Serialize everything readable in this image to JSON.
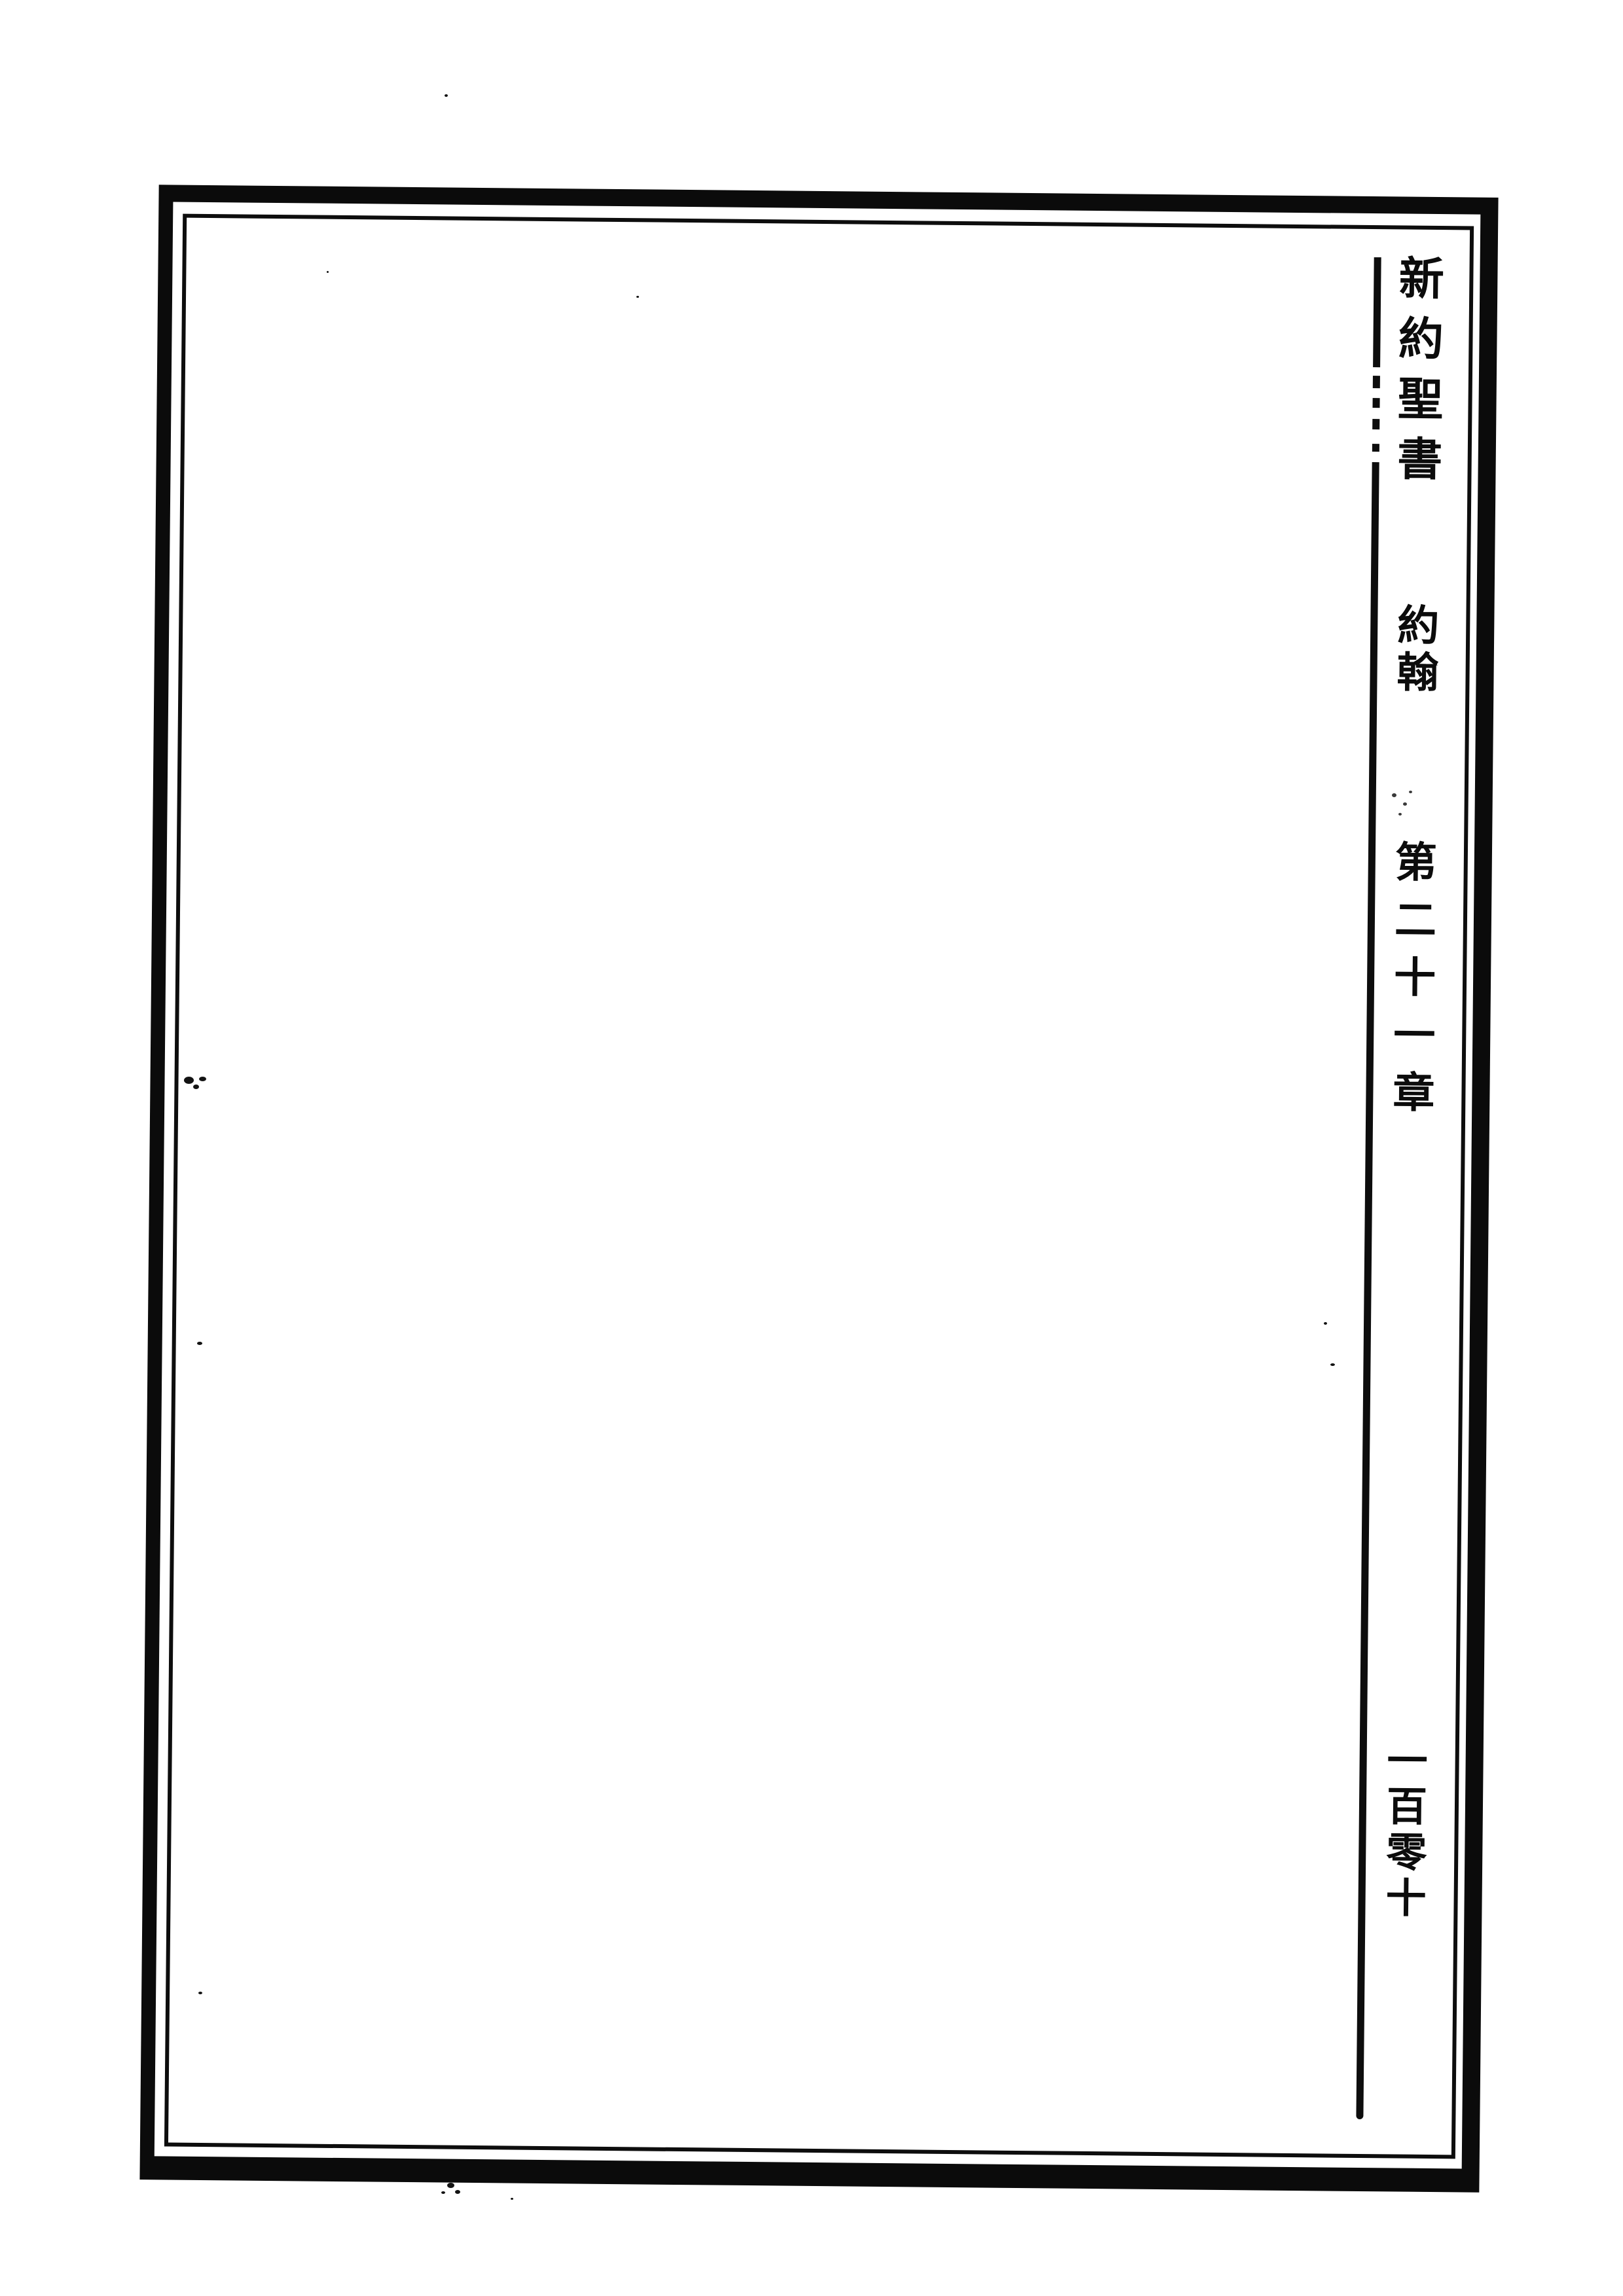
{
  "colors": {
    "ink": "#0b0b0b",
    "paper": "#ffffff"
  },
  "margin_column": {
    "book_title": "新約聖書",
    "section_title": "約翰",
    "chapter_heading": "第二十一章",
    "page_number": "一百零十"
  }
}
